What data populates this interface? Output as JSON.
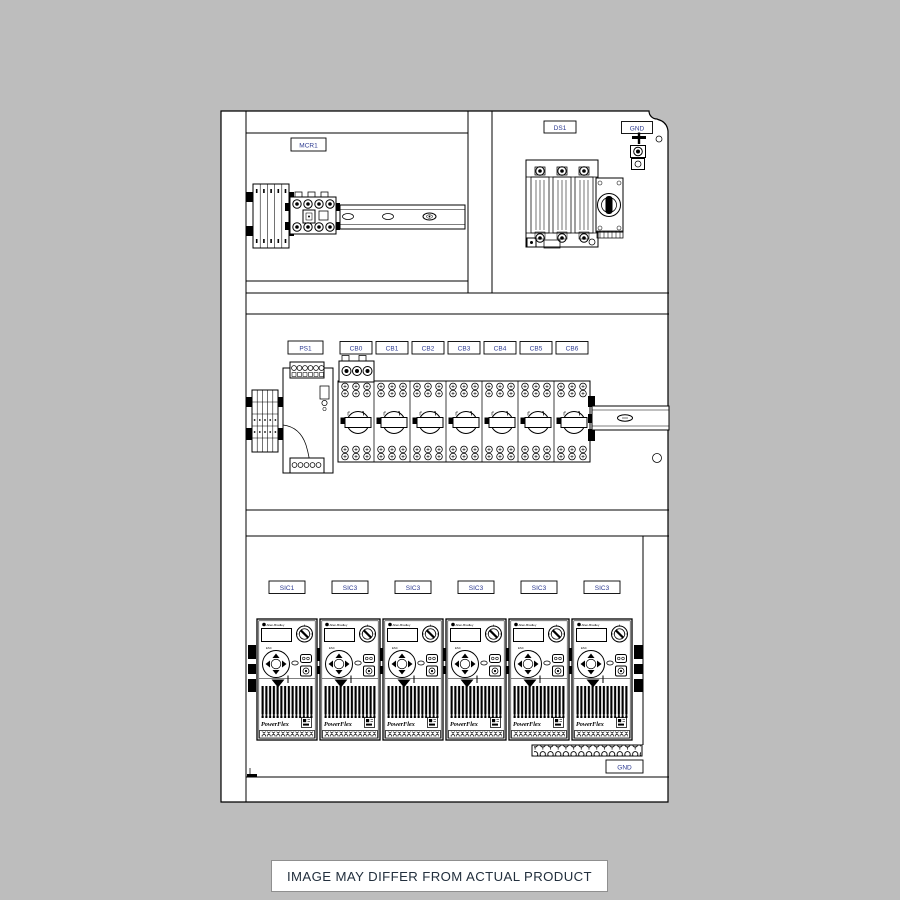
{
  "colors": {
    "background": "#bdbdbd",
    "panel": "#ffffff",
    "line": "#000000",
    "tag_text": "#2b3990",
    "caption_text": "#222f3d"
  },
  "panel": {
    "top_left_section": {
      "tag": "MCR1"
    },
    "top_right_section": {
      "tag": "DS1",
      "ground_tag": "GND"
    },
    "middle_section": {
      "power_supply_tag": "PS1",
      "breaker_tags": [
        "CB0",
        "CB1",
        "CB2",
        "CB3",
        "CB4",
        "CB5",
        "CB6"
      ]
    },
    "bottom_section": {
      "drive_tags": [
        "SIC1",
        "SIC3",
        "SIC3",
        "SIC3",
        "SIC3",
        "SIC3"
      ],
      "ground_tag": "GND",
      "drive": {
        "brand": "Allen-Bradley",
        "model": "PowerFlex",
        "esc": "ESC"
      }
    }
  },
  "caption": {
    "text": "IMAGE MAY DIFFER FROM ACTUAL PRODUCT"
  }
}
